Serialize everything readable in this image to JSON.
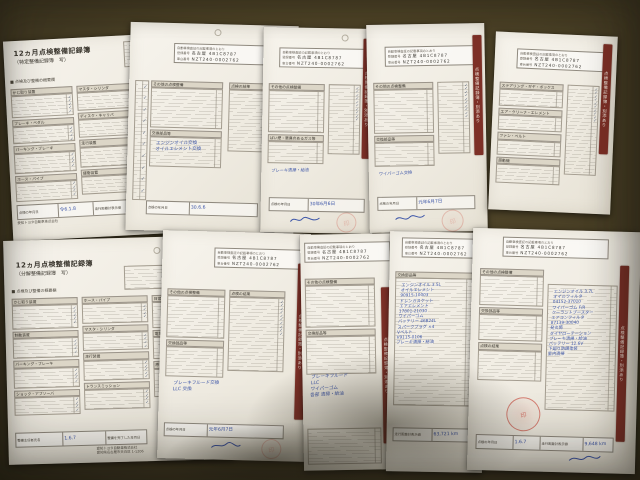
{
  "titles": {
    "main": "12ヵ月点検整備記録簿",
    "sub_tokutei": "（特定整備記録簿　写）",
    "sub_bunkai": "（分解整備記録簿　写）",
    "overview": "■ 点検及び整備の概要欄"
  },
  "form": {
    "note": "自動車検査証の記載事項のとおり",
    "reg_label": "登録番号",
    "reg_value": "名古屋 4B1C8787",
    "vin_label": "車台番号",
    "vin_value": "NZT240-0002762",
    "banner": "点検整備記録簿・別添あり"
  },
  "labels": {
    "sec": [
      "かじ取り装置",
      "制動装置",
      "パーキング・ブレーキ",
      "ホース・パイプ",
      "マスタ・シリンダ",
      "走行装置",
      "緩衝装置",
      "動力伝達装置",
      "電気装置",
      "原動機",
      "ブレーキ・ペダル",
      "ディスク・キャリパ",
      "ホイール",
      "点火装置",
      "バッテリ",
      "エア・クリーナ・エレメント",
      "ファン・ベルト",
      "冷却装置",
      "その他の点検整備",
      "交換部品等",
      "点検の結果",
      "日常点検",
      "ばい煙・悪臭のあるガス等",
      "ステアリング・ギヤ・ボックス",
      "ショック・アブソーバ",
      "プロペラ・シャフト",
      "トランスミッション"
    ]
  },
  "ticks": {
    "t4": "✓\n✓\n✓\n✓",
    "t5": "✓\n✓\n✓\n✓\n✓",
    "t6": "✓\n✓\n✓\n✓\n✓\n✓",
    "t10": "✓\n✓\n✓\n✓\n✓\n✓\n✓\n✓\n✓\n✓",
    "row": "✓ ✓ ✓ ✓"
  },
  "hand": {
    "date_a": "令6.1.8",
    "date_b": "30.6.6",
    "date_c": "30年6月6日",
    "date_d": "元年6月7日",
    "date_g": "元年6月7日",
    "date_j": "1.6.7",
    "mile_i": "63,721 km",
    "mile_j": "9,648 km",
    "b_note": "エンジンオイル交換\nオイルエレメント交換",
    "c_note": "ブレーキ清掃・給油",
    "d_note": "ワイパーゴム交換",
    "g_note": "ブレーキフルード交換\nLLC 交換",
    "h_note": "ブレーキフルード\nLLC\nワイパーゴム\n各部 清掃・給油",
    "i_list": "エンジンオイル 3.5L\nオイルエレメント\n90915-10003\nドレンガスケット\nエアエレメント\n17801-21030\nワイパーゴム\nバッテリー 46B24L\nスパークプラグ ×4\nVベルト\nV9115-0106\nブレーキ清掃・給油",
    "j_list": "エンジンオイル 3.7L\nオイルフィルタ\n04152-37010\nワイパーゴム F/R\nクーラントブースター\nエアコンフィルタ\n87139-30040\n発炎筒\nタイヤローテーション\nブレーキ清掃・給油\nバッテリー 12.6V\n下廻り防錆塗装\n室内清掃"
  },
  "footer": {
    "date_label": "点検の年月日",
    "complete_label": "整備を完了した年月日",
    "mileage_label": "走行距離計表示値",
    "chief_label": "整備主任者氏名",
    "company": "愛知トヨタ自動車株式会社",
    "address": "愛知県名古屋市天白区 1-1206"
  },
  "stamps": {
    "circle": "印",
    "sq1": "検",
    "sq2": "整"
  }
}
